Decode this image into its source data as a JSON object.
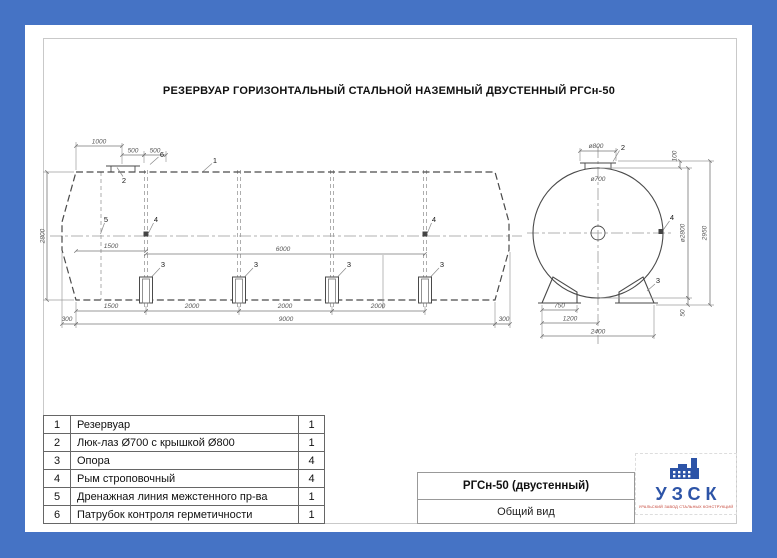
{
  "window": {
    "background_color": "#4573c5"
  },
  "title": "РЕЗЕРВУАР ГОРИЗОНТАЛЬНЫЙ СТАЛЬНОЙ НАЗЕМНЫЙ ДВУСТЕННЫЙ РГСн-50",
  "markers": {
    "m1": "1",
    "m2": "2",
    "m3": "3",
    "m4": "4",
    "m5": "5",
    "m6": "6"
  },
  "side_view": {
    "dims": {
      "d1000": "1000",
      "d500a": "500",
      "d500b": "500",
      "d2800": "2800",
      "d1500_rym": "1500",
      "d6000": "6000",
      "seg1": "1500",
      "seg2": "2000",
      "seg3": "2000",
      "seg4": "2000",
      "cone_l": "300",
      "d9000": "9000",
      "cone_r": "300"
    }
  },
  "end_view": {
    "dims": {
      "cover": "ø800",
      "neck": "ø700",
      "h100": "100",
      "shell": "ø2800",
      "h2950": "2950",
      "h50": "50",
      "w750": "750",
      "w1200": "1200",
      "w2400": "2400"
    }
  },
  "parts_table": {
    "rows": [
      {
        "num": "1",
        "name": "Резервуар",
        "qty": "1"
      },
      {
        "num": "2",
        "name": "Люк-лаз Ø700 с крышкой Ø800",
        "qty": "1"
      },
      {
        "num": "3",
        "name": "Опора",
        "qty": "4"
      },
      {
        "num": "4",
        "name": "Рым строповочный",
        "qty": "4"
      },
      {
        "num": "5",
        "name": "Дренажная линия межстенного пр-ва",
        "qty": "1"
      },
      {
        "num": "6",
        "name": "Патрубок контроля герметичности",
        "qty": "1"
      }
    ]
  },
  "title_block": {
    "model": "РГСн-50 (двустенный)",
    "view": "Общий вид"
  },
  "logo": {
    "name": "УЗСК",
    "tagline": "УРАЛЬСКИЙ ЗАВОД СТАЛЬНЫХ КОНСТРУКЦИЙ",
    "name_color": "#2d54a7",
    "tagline_color": "#c0392b"
  }
}
